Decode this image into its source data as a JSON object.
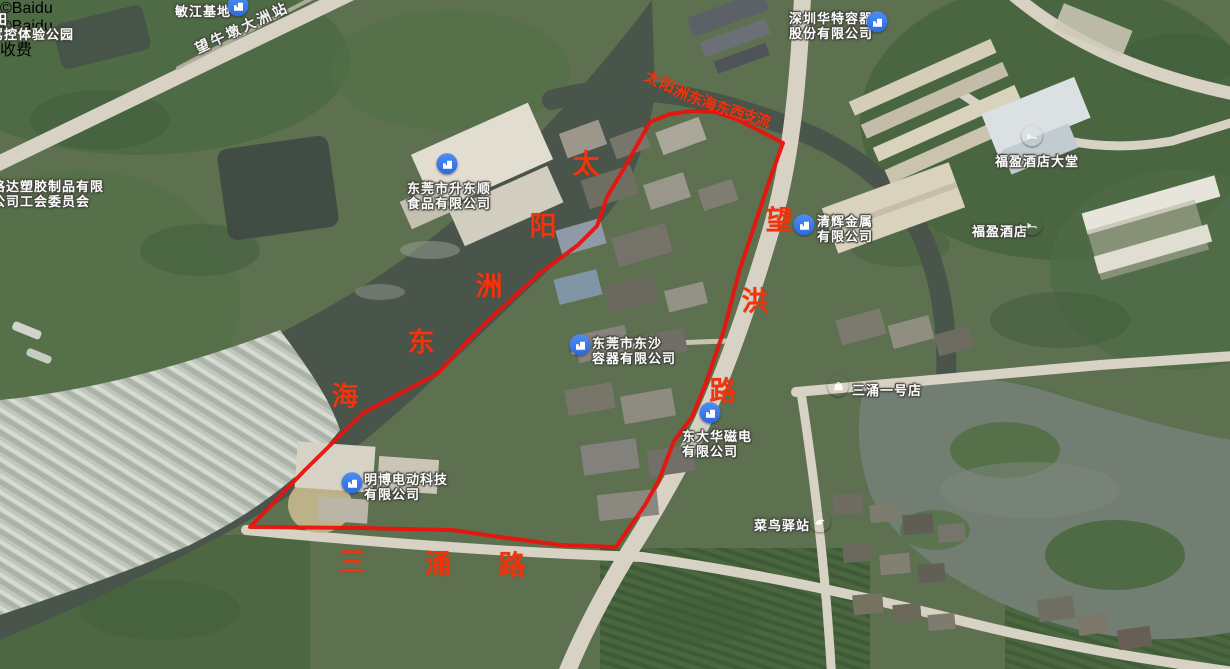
{
  "attribution": {
    "text": "©Baidu"
  },
  "watermarks": [
    {
      "x": 1010,
      "y": 55
    },
    {
      "x": 1022,
      "y": 474
    }
  ],
  "toll_badge": {
    "label": "收费",
    "x": 1095,
    "y": 37
  },
  "poi_labels": [
    {
      "name": "tian-label",
      "lines": [
        "田"
      ],
      "x": -6,
      "y": 12
    },
    {
      "name": "jiakong-experience-park",
      "lines": [
        "驾控体验公园"
      ],
      "x": -10,
      "y": 27
    },
    {
      "name": "minjiang-base",
      "lines": [
        "敏江基地"
      ],
      "x": 175,
      "y": 4,
      "icon": {
        "type": "building",
        "x": 238,
        "y": 12
      }
    },
    {
      "name": "wangniudun-dazhou-station",
      "lines": [
        "望牛墩大洲站"
      ],
      "x": 196,
      "y": 42,
      "rotate": -25
    },
    {
      "name": "shenzhen-huate-container",
      "lines": [
        "深圳华特容器",
        "股份有限公司"
      ],
      "x": 789,
      "y": 11,
      "icon": {
        "type": "building",
        "x": 877,
        "y": 28
      }
    },
    {
      "name": "shengdongshun-food",
      "lines": [
        "东莞市升东顺",
        "食品有限公司"
      ],
      "x": 407,
      "y": 181,
      "icon": {
        "type": "building",
        "x": 447,
        "y": 170
      }
    },
    {
      "name": "geda-plastic-union",
      "lines": [
        "格达塑胶制品有限",
        "公司工会委员会"
      ],
      "x": -8,
      "y": 179
    },
    {
      "name": "dongsha-container",
      "lines": [
        "东莞市东沙",
        "容器有限公司"
      ],
      "x": 592,
      "y": 336,
      "icon": {
        "type": "building",
        "x": 580,
        "y": 351
      }
    },
    {
      "name": "qinghui-metal",
      "lines": [
        "清辉金属",
        "有限公司"
      ],
      "x": 817,
      "y": 214,
      "icon": {
        "type": "building",
        "x": 804,
        "y": 231
      }
    },
    {
      "name": "sanchong-no1-store",
      "lines": [
        "三涌一号店"
      ],
      "x": 852,
      "y": 383,
      "icon": {
        "type": "shop",
        "x": 838,
        "y": 392
      }
    },
    {
      "name": "dongdahua-magnet",
      "lines": [
        "东大华磁电",
        "有限公司"
      ],
      "x": 682,
      "y": 429,
      "icon": {
        "type": "building",
        "x": 710,
        "y": 419
      }
    },
    {
      "name": "mingbo-electric",
      "lines": [
        "明博电动科技",
        "有限公司"
      ],
      "x": 364,
      "y": 472,
      "icon": {
        "type": "building",
        "x": 352,
        "y": 489
      }
    },
    {
      "name": "cainiao-station",
      "lines": [
        "菜鸟驿站"
      ],
      "x": 754,
      "y": 518,
      "icon": {
        "type": "cainiao",
        "x": 820,
        "y": 528
      }
    },
    {
      "name": "fuying-hotel-lobby",
      "lines": [
        "福盈酒店大堂"
      ],
      "x": 995,
      "y": 154,
      "icon": {
        "type": "hotel",
        "x": 1032,
        "y": 142
      }
    },
    {
      "name": "fuying-hotel",
      "lines": [
        "福盈酒店"
      ],
      "x": 972,
      "y": 224,
      "icon": {
        "type": "hotel",
        "x": 1032,
        "y": 231
      }
    }
  ],
  "road_labels": [
    {
      "name": "taiyangzhou-donghai-channel",
      "size": 15,
      "chars": [
        {
          "ch": "太",
          "x": 652,
          "y": 79,
          "r": 26
        },
        {
          "ch": "阳",
          "x": 667,
          "y": 86,
          "r": 25
        },
        {
          "ch": "洲",
          "x": 681,
          "y": 93,
          "r": 24
        },
        {
          "ch": "东",
          "x": 695,
          "y": 99,
          "r": 23
        },
        {
          "ch": "海",
          "x": 709,
          "y": 104,
          "r": 22
        },
        {
          "ch": "东",
          "x": 723,
          "y": 109,
          "r": 21
        },
        {
          "ch": "西",
          "x": 737,
          "y": 113,
          "r": 20
        },
        {
          "ch": "支",
          "x": 750,
          "y": 117,
          "r": 19
        },
        {
          "ch": "流",
          "x": 763,
          "y": 121,
          "r": 18
        }
      ]
    },
    {
      "name": "taiyangzhou-donghai-river",
      "size": 27,
      "chars": [
        {
          "ch": "太",
          "x": 586,
          "y": 165,
          "r": 0
        },
        {
          "ch": "阳",
          "x": 543,
          "y": 227,
          "r": 0
        },
        {
          "ch": "洲",
          "x": 489,
          "y": 287,
          "r": 0
        },
        {
          "ch": "东",
          "x": 421,
          "y": 343,
          "r": 0
        },
        {
          "ch": "海",
          "x": 345,
          "y": 397,
          "r": 0
        }
      ]
    },
    {
      "name": "wanghong-road",
      "size": 27,
      "chars": [
        {
          "ch": "望",
          "x": 779,
          "y": 221,
          "r": 0
        },
        {
          "ch": "洪",
          "x": 755,
          "y": 302,
          "r": 0
        },
        {
          "ch": "路",
          "x": 723,
          "y": 392,
          "r": 0
        }
      ]
    },
    {
      "name": "sanchong-road",
      "size": 27,
      "chars": [
        {
          "ch": "三",
          "x": 352,
          "y": 563,
          "r": 0
        },
        {
          "ch": "涌",
          "x": 438,
          "y": 565,
          "r": 0
        },
        {
          "ch": "路",
          "x": 512,
          "y": 566,
          "r": 0
        }
      ]
    }
  ],
  "boundary": {
    "color": "#e9130d",
    "stroke_width": 4,
    "points": "650,122 670,114 693,111 715,112 736,119 760,131 783,143 770,179 753,230 739,272 724,330 706,383 692,417 674,441 659,480 645,505 616,547 560,545 500,537 452,530 360,528 250,527 305,470 363,413 437,374 481,327 539,274 578,245 597,226 607,197 626,165"
  },
  "stray_icons": [
    {
      "name": "partial-poi-pin",
      "x": 287,
      "y": 663
    }
  ]
}
